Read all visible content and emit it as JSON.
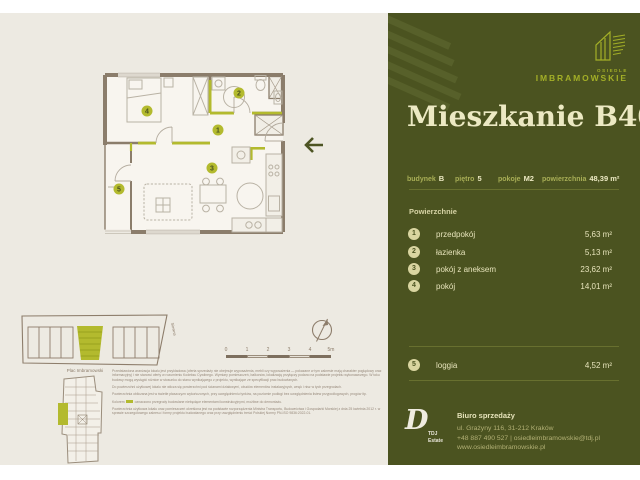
{
  "brand": {
    "logo_line1": "OSIEDLE",
    "logo_line2": "IMBRAMOWSKIE"
  },
  "listing": {
    "title": "Mieszkanie B40",
    "details": [
      {
        "label": "budynek",
        "value": "B"
      },
      {
        "label": "piętro",
        "value": "5"
      },
      {
        "label": "pokoje",
        "value": "M2"
      },
      {
        "label": "powierzchnia",
        "value": "48,39 m²"
      }
    ],
    "areas_heading": "Powierzchnie",
    "rooms": [
      {
        "num": "1",
        "label": "przedpokój",
        "value": "5,63 m²"
      },
      {
        "num": "2",
        "label": "łazienka",
        "value": "5,13 m²"
      },
      {
        "num": "3",
        "label": "pokój z aneksem",
        "value": "23,62 m²"
      },
      {
        "num": "4",
        "label": "pokój",
        "value": "14,01 m²"
      }
    ],
    "loggia": {
      "num": "5",
      "label": "loggia",
      "value": "4,52 m²"
    }
  },
  "floorplan": {
    "markers": [
      "1",
      "2",
      "3",
      "4",
      "5"
    ]
  },
  "siteplan": {
    "label": "Plac Imbramowski",
    "street": "Siewna"
  },
  "scalebar": {
    "ticks": [
      "0",
      "1",
      "2",
      "3",
      "4",
      "5m"
    ]
  },
  "disclaimer": {
    "p1": "Przedstawiona aranżacja lokalu jest przykładowa (oferta sprzedaży nie obejmuje wyposażenia, mebli czy wyposażenia — pokazane w tym zakresie mają charakter poglądowy oraz informacyjny) i nie stanowi oferty w rozumieniu Kodeksu Cywilnego. Wymiary pomieszczeń, balkonów, lokalizację przyłączy podano na podstawie projektu wykonawczego. W toku budowy mogą wystąpić różnice w stosunku do stanu wynikającego z projektu, wynikające ze specyfikacji prac budowlanych.",
    "p2": "Do powierzchni użytkowej lokalu nie wlicza się powierzchni pod ścianami działowymi, obudów elementów instalacyjnych, wnęk i nisz w tych przegrodach.",
    "p3": "Powierzchnia obliczana jest w świetle płaszczyzn wykończonych, przy uwzględnieniu tynków, na poziomie podłogi bez uwzględnienia listew przypodłogowych, progów itp.",
    "kolorem_prefix": "Kolorem",
    "kolorem_suffix": "oznaczono przegrody budowlane niebędące elementami konstrukcyjnymi, możliwe do demontażu.",
    "p5": "Powierzchnia użytkowa lokalu oraz pomieszczeń określona jest na podstawie rozporządzenia Ministra Transportu, Budownictwa i Gospodarki Morskiej z dnia 25 kwietnia 2012 r. w sprawie szczegółowego zakresu i formy projektu budowlanego oraz przy uwzględnieniu treści Polskiej Normy PN-ISO 9836:2022-01."
  },
  "footer": {
    "brand_glyph": "D",
    "brand_line1": "TDJ",
    "brand_line2": "Estate",
    "office_title": "Biuro sprzedaży",
    "address": "ul. Grażyny 116, 31-212 Kraków",
    "phone_email": "+48 887 490 527 | osiedleimbramowskie@tdj.pl",
    "website": "www.osiedleimbramowskie.pl"
  },
  "colors": {
    "panel_green": "#4b5320",
    "accent_yellow": "#b3ba2e",
    "cream_bg": "#edeae2",
    "text_cream": "#ece9c3"
  }
}
